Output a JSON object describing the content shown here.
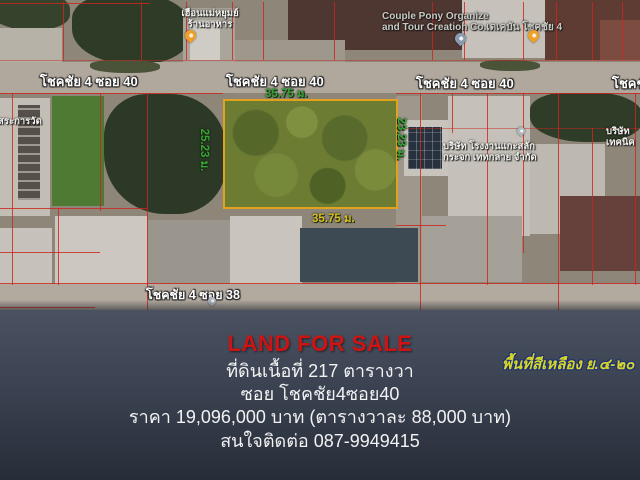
{
  "map": {
    "poi_restaurant": {
      "line1": "เฮือนแม่หยุมย์",
      "line2": "ร้านอาหาร"
    },
    "poi_couple_pony": {
      "line1": "Couple Pony Organize",
      "line2": "and Tour Creation Co.เดเคบัน โชคชัย 4"
    },
    "street_40_labels": [
      "โชคชัย 4 ซอย 40",
      "โชคชัย 4 ซอย 40",
      "โชคชัย 4 ซอย 40",
      "โชคชั"
    ],
    "street_38_label": "โชคชัย 4 ซอย 38",
    "poi_left_clipped": "นยิสระการวัด",
    "poi_glass_company": {
      "line1": "บริษัท โรงงานแกะสลัก",
      "line2": "กระจก เททกลาย จำกัด"
    },
    "poi_right_clipped": {
      "line1": "บริษัท",
      "line2": "เทคนิค"
    },
    "plot": {
      "width_top": "35.75 ม.",
      "width_bottom": "35.75 ม.",
      "depth_left": "25.23 ม.",
      "depth_right": "23.23 ม."
    }
  },
  "panel": {
    "headline": "LAND FOR SALE",
    "area_line": "ที่ดินเนื้อที่ 217 ตารางวา",
    "soi_line": "ซอย โชคชัย4ซอย40",
    "price_line": "ราคา 19,096,000 บาท (ตารางวาละ 88,000 บาท)",
    "contact_line": "สนใจติดต่อ 087-9949415",
    "zoning_note": "พื้นที่สีเหลือง ย.๔-๒๐"
  },
  "colors": {
    "headline_red": "#ce1313",
    "zoning_yellow": "#d6d628",
    "zoning_outline_navy": "#1b2f7a",
    "dimension_green": "#35a437",
    "dimension_yellow": "#d8be1e",
    "plot_border_orange": "#e2a21c",
    "plot_fill_olive": "#6d7c33",
    "parcel_line_red": "#cd261c",
    "panel_top": "#4a5261",
    "panel_bottom": "#272d38"
  }
}
